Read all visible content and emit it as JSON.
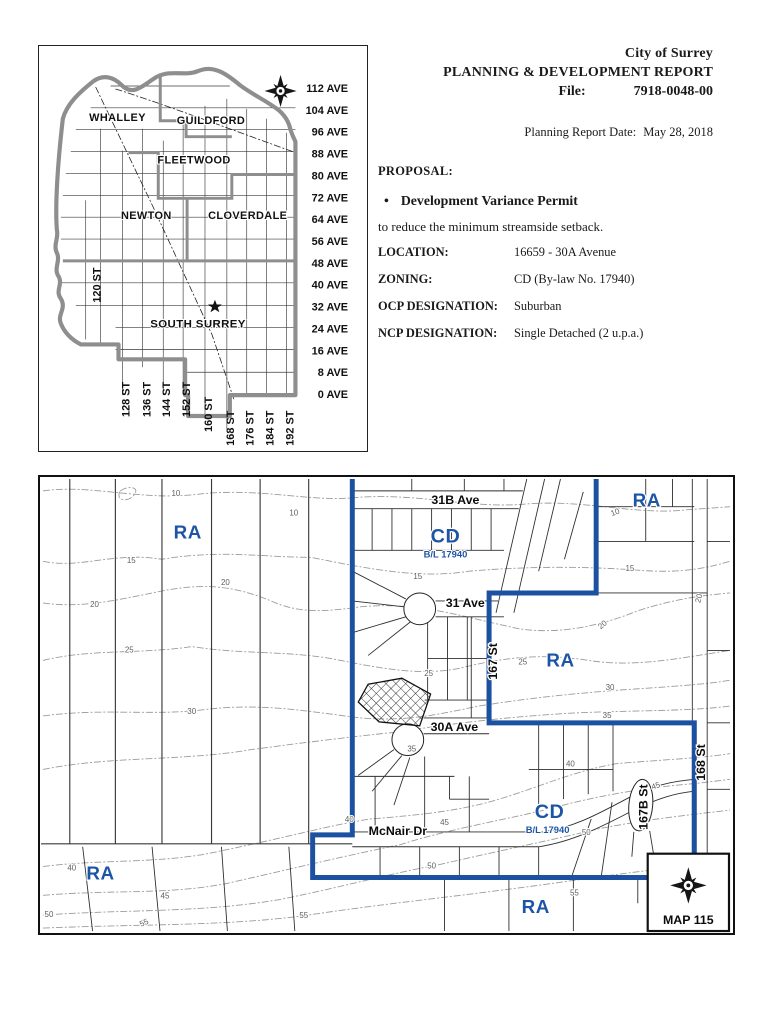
{
  "header": {
    "city": "City of Surrey",
    "report_title": "PLANNING & DEVELOPMENT REPORT",
    "file_label": "File:",
    "file_number": "7918-0048-00",
    "date_label": "Planning Report Date:",
    "date_value": "May 28, 2018"
  },
  "proposal": {
    "heading": "PROPOSAL:",
    "bullet_marker": "•",
    "bullet_text": "Development Variance Permit",
    "description": "to reduce the minimum streamside setback.",
    "fields": [
      {
        "label": "LOCATION:",
        "value": "16659 - 30A Avenue"
      },
      {
        "label": "ZONING:",
        "value": "CD (By-law No. 17940)"
      },
      {
        "label": "OCP DESIGNATION:",
        "value": "Suburban"
      },
      {
        "label": "NCP DESIGNATION:",
        "value": "Single Detached (2 u.p.a.)"
      }
    ]
  },
  "locator_map": {
    "districts": [
      {
        "t": "WHALLEY",
        "x": 117,
        "y": 120
      },
      {
        "t": "GUILDFORD",
        "x": 211,
        "y": 123
      },
      {
        "t": "FLEETWOOD",
        "x": 194,
        "y": 163
      },
      {
        "t": "NEWTON",
        "x": 146,
        "y": 219
      },
      {
        "t": "CLOVERDALE",
        "x": 248,
        "y": 219
      },
      {
        "t": "SOUTH SURREY",
        "x": 198,
        "y": 328,
        "big": true
      }
    ],
    "avenues": [
      {
        "t": "112 AVE",
        "y": 91
      },
      {
        "t": "104 AVE",
        "y": 113
      },
      {
        "t": "96 AVE",
        "y": 135
      },
      {
        "t": "88 AVE",
        "y": 157
      },
      {
        "t": "80 AVE",
        "y": 179
      },
      {
        "t": "72 AVE",
        "y": 201
      },
      {
        "t": "64 AVE",
        "y": 223
      },
      {
        "t": "56 AVE",
        "y": 245
      },
      {
        "t": "48 AVE",
        "y": 267
      },
      {
        "t": "40 AVE",
        "y": 289
      },
      {
        "t": "32 AVE",
        "y": 311
      },
      {
        "t": "24 AVE",
        "y": 333
      },
      {
        "t": "16 AVE",
        "y": 355
      },
      {
        "t": "8 AVE",
        "y": 377
      },
      {
        "t": "0 AVE",
        "y": 399
      }
    ],
    "streets_bottom": [
      {
        "t": "128 ST",
        "x": 129,
        "y": 418
      },
      {
        "t": "136 ST",
        "x": 150,
        "y": 418
      },
      {
        "t": "144 ST",
        "x": 170,
        "y": 418
      },
      {
        "t": "152 ST",
        "x": 190,
        "y": 418
      },
      {
        "t": "160 ST",
        "x": 212,
        "y": 433
      },
      {
        "t": "168 ST",
        "x": 234,
        "y": 447
      },
      {
        "t": "176 ST",
        "x": 254,
        "y": 447
      },
      {
        "t": "184 ST",
        "x": 274,
        "y": 447
      },
      {
        "t": "192 ST",
        "x": 294,
        "y": 447
      }
    ],
    "street_left": {
      "t": "120 ST",
      "x": 100,
      "y": 303
    }
  },
  "zoning_map": {
    "map_sheet": "MAP 115",
    "zone_labels": [
      {
        "t": "RA",
        "x": 186,
        "y": 537,
        "s": 19
      },
      {
        "t": "RA",
        "x": 649,
        "y": 505,
        "s": 19
      },
      {
        "t": "RA",
        "x": 562,
        "y": 666,
        "s": 19
      },
      {
        "t": "RA",
        "x": 98,
        "y": 881,
        "s": 19
      },
      {
        "t": "RA",
        "x": 537,
        "y": 915,
        "s": 19
      },
      {
        "t": "CD",
        "x": 446,
        "y": 541,
        "s": 20
      },
      {
        "t": "CD",
        "x": 551,
        "y": 819,
        "s": 20
      }
    ],
    "bylaw_labels": [
      {
        "t": "B/L 17940",
        "x": 446,
        "y": 556
      },
      {
        "t": "B/L 17940",
        "x": 549,
        "y": 834
      }
    ],
    "street_labels": [
      {
        "t": "31B Ave",
        "x": 456,
        "y": 502
      },
      {
        "t": "31 Ave",
        "x": 466,
        "y": 606
      },
      {
        "t": "30A Ave",
        "x": 455,
        "y": 731
      },
      {
        "t": "McNair Dr",
        "x": 398,
        "y": 836
      },
      {
        "t": "167 St",
        "x": 498,
        "y": 661,
        "rot": -90
      },
      {
        "t": "168 St",
        "x": 708,
        "y": 763,
        "rot": -90
      },
      {
        "t": "167B St",
        "x": 650,
        "y": 808,
        "rot": -90,
        "s": 11
      }
    ],
    "contour_labels": [
      {
        "t": "10",
        "x": 174,
        "y": 494
      },
      {
        "t": "10",
        "x": 293,
        "y": 514
      },
      {
        "t": "10",
        "x": 618,
        "y": 513,
        "rot": -20
      },
      {
        "t": "15",
        "x": 129,
        "y": 562
      },
      {
        "t": "15",
        "x": 418,
        "y": 578
      },
      {
        "t": "15",
        "x": 632,
        "y": 570
      },
      {
        "t": "20",
        "x": 92,
        "y": 606
      },
      {
        "t": "20",
        "x": 224,
        "y": 584
      },
      {
        "t": "20",
        "x": 606,
        "y": 626,
        "rot": -40
      },
      {
        "t": "20",
        "x": 704,
        "y": 598,
        "rot": -75
      },
      {
        "t": "25",
        "x": 127,
        "y": 652
      },
      {
        "t": "25",
        "x": 429,
        "y": 676
      },
      {
        "t": "25",
        "x": 524,
        "y": 664
      },
      {
        "t": "30",
        "x": 190,
        "y": 714
      },
      {
        "t": "30",
        "x": 612,
        "y": 690
      },
      {
        "t": "35",
        "x": 609,
        "y": 718
      },
      {
        "t": "35",
        "x": 412,
        "y": 752
      },
      {
        "t": "40",
        "x": 349,
        "y": 823
      },
      {
        "t": "40",
        "x": 69,
        "y": 872
      },
      {
        "t": "40",
        "x": 572,
        "y": 767
      },
      {
        "t": "45",
        "x": 445,
        "y": 826
      },
      {
        "t": "45",
        "x": 163,
        "y": 900
      },
      {
        "t": "45",
        "x": 659,
        "y": 789,
        "rot": -20
      },
      {
        "t": "50",
        "x": 432,
        "y": 870
      },
      {
        "t": "50",
        "x": 588,
        "y": 836
      },
      {
        "t": "50",
        "x": 46,
        "y": 919
      },
      {
        "t": "55",
        "x": 576,
        "y": 897
      },
      {
        "t": "55",
        "x": 303,
        "y": 920
      },
      {
        "t": "55",
        "x": 143,
        "y": 927,
        "rot": -25
      }
    ]
  },
  "colors": {
    "zone_blue": "#1d55a6",
    "boundary_blue": "#1b51a0"
  }
}
